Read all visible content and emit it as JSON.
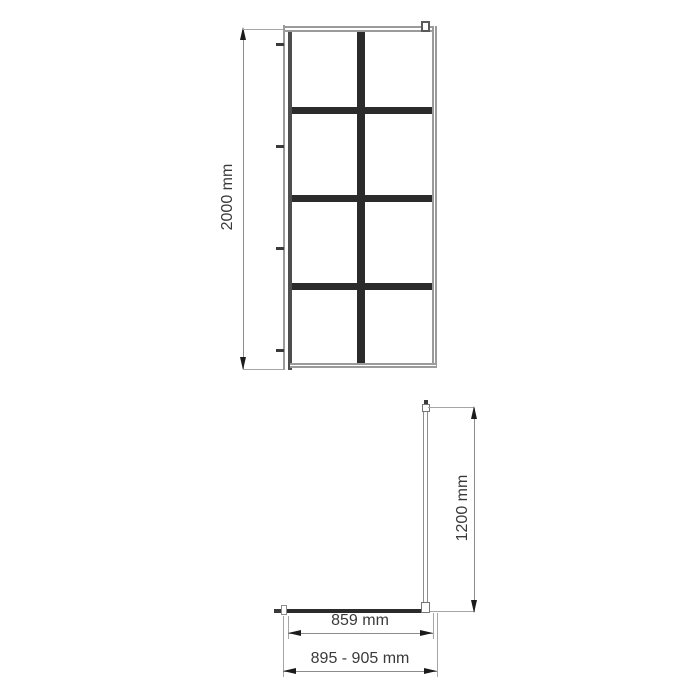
{
  "diagram": {
    "type": "technical-installation-drawing",
    "front_view": {
      "height_dimension_label": "2000 mm",
      "grid_columns": 2,
      "grid_rows": 4
    },
    "plan_view": {
      "support_bar_dimension_label": "1200 mm",
      "glass_width_dimension_label": "859 mm",
      "total_width_dimension_label": "895 - 905 mm"
    },
    "colors": {
      "grid_bar": "#2b2b2b",
      "drafting_line": "#8c8c8c",
      "text": "#3a3a3a",
      "background": "#ffffff"
    }
  }
}
